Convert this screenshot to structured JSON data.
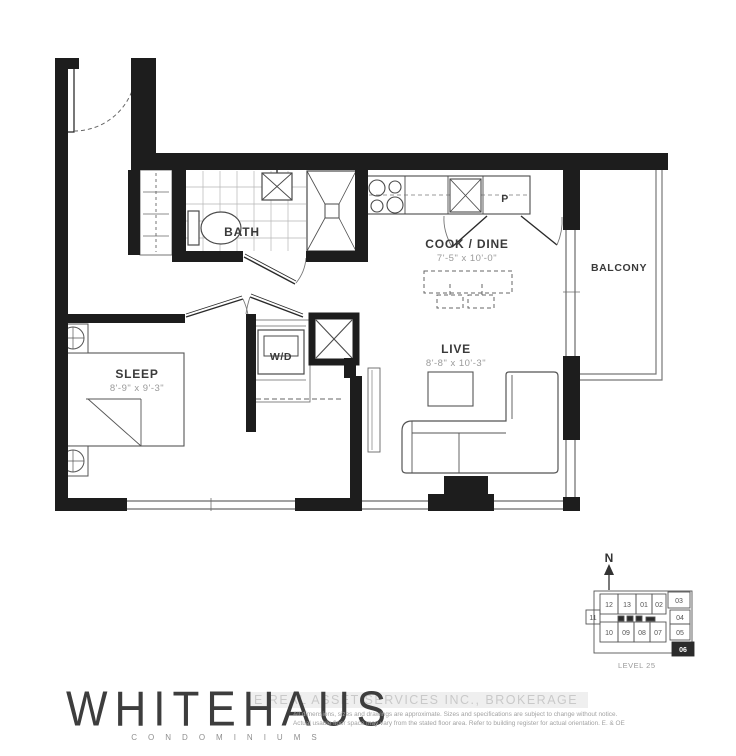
{
  "floorplan": {
    "rooms": {
      "sleep": {
        "label": "SLEEP",
        "dims": "8'-9\" x 9'-3\""
      },
      "bath": {
        "label": "BATH"
      },
      "cook_dine": {
        "label": "COOK / DINE",
        "dims": "7'-5\" x 10'-0\""
      },
      "live": {
        "label": "LIVE",
        "dims": "8'-8\" x 10'-3\""
      },
      "balcony": {
        "label": "BALCONY"
      },
      "wd": {
        "label": "W/D"
      },
      "pantry": {
        "label": "P"
      }
    }
  },
  "keyplan": {
    "north_label": "N",
    "level_label": "LEVEL 25",
    "highlighted_unit": "06",
    "units": [
      "12",
      "13",
      "01",
      "02",
      "03",
      "04",
      "05",
      "06",
      "07",
      "08",
      "09",
      "10",
      "11"
    ]
  },
  "branding": {
    "logo_text": "WHITEHAUS",
    "logo_subtitle": "CONDOMINIUMS"
  },
  "watermark": {
    "text": "E REAL ASSET SERVICES INC., BROKERAGE"
  },
  "disclaimer": {
    "line1": "All dimensions, sizes and drawings are approximate. Sizes and specifications are subject to change without notice.",
    "line2": "Actual usable floor space may vary from the stated floor area. Refer to building register for actual orientation. E. & OE"
  },
  "colors": {
    "wall": "#1d1d1d",
    "thin_line": "#555555",
    "tile_line": "#b5b5b5",
    "dim_text": "#9a9a9a",
    "label_text": "#3a3a3a",
    "highlight_unit_fill": "#2b2b2b"
  }
}
